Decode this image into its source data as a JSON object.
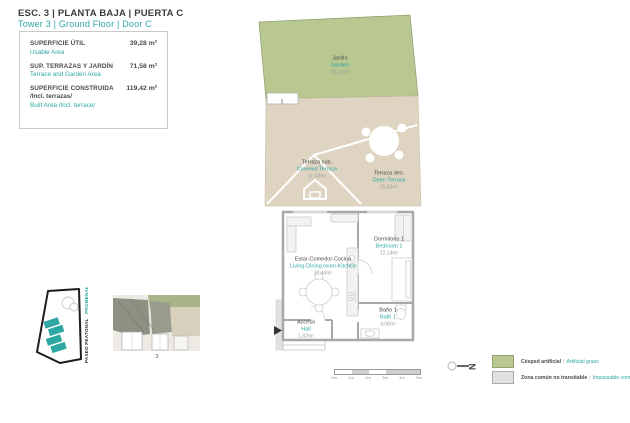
{
  "accent_color": "#2ea7a2",
  "header": {
    "title": "ESC. 3 | PLANTA BAJA | PUERTA C",
    "subtitle": "Tower 3 | Ground Floor | Door C"
  },
  "info_box": {
    "row1": {
      "label": "SUPERFICIE ÚTIL",
      "value": "39,28 m²",
      "sublabel": "Usable Area"
    },
    "row2": {
      "label": "SUP. TERRAZAS Y JARDÍN",
      "value": "71,58 m²",
      "sublabel": "Terrace and Garden Area"
    },
    "row3": {
      "label": "SUPERFICIE CONSTRUIDA",
      "value": "119,42 m²",
      "label2": "/Incl. terrazas/",
      "sublabel": "Built Area /Incl. terrace/"
    }
  },
  "floorplan": {
    "rooms": {
      "garden": {
        "es": "Jardín",
        "en": "Garden",
        "area": "35,13m²"
      },
      "covered_terrace": {
        "es": "Terraza cub.",
        "en": "Covered Terrace",
        "area": "11,43m²"
      },
      "open_terrace": {
        "es": "Terraza des.",
        "en": "Open Terrace",
        "area": "25,02m²"
      },
      "living": {
        "es": "Estar-Comedor-Cocina",
        "en": "Living-Dining room-Kitchen",
        "area": "21,44m²"
      },
      "bedroom1": {
        "es": "Dormitorio 1",
        "en": "Bedroom 1",
        "area": "12,14m²"
      },
      "bath1": {
        "es": "Baño 1",
        "en": "Bath 1",
        "area": "4,08m²"
      },
      "hall": {
        "es": "Acceso",
        "en": "Hall",
        "area": "1,62m²"
      }
    },
    "colors": {
      "garden": "#b9c791",
      "terrace": "#ded4c1",
      "walls": "#a8a8a8"
    }
  },
  "site_plan": {
    "street_label": "PASEO PEATONAL",
    "street_label_en": "PROMENADE"
  },
  "overview": {
    "tower_number": "3"
  },
  "scale_bar": {
    "ticks": [
      "0m",
      "1m",
      "2m",
      "3m",
      "4m",
      "5m"
    ]
  },
  "compass": {
    "label": "N"
  },
  "legend": {
    "separator": "|",
    "item1": {
      "es": "Césped artificial",
      "en": "Artificial grass",
      "color": "#b9c791"
    },
    "item2": {
      "es": "Zona común no transitable",
      "en": "Impassable communal area",
      "color": "#e0e0e0"
    }
  }
}
